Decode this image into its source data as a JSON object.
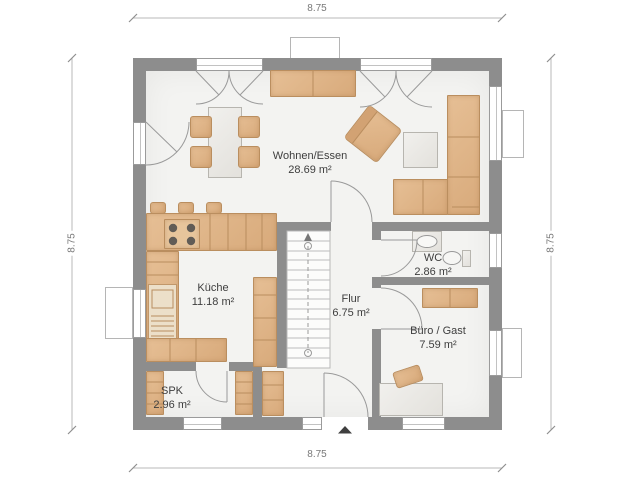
{
  "dimensions": {
    "top": "8.75",
    "right": "8.75",
    "bottom": "8.75",
    "left": "8.75"
  },
  "rooms": {
    "wohnen": {
      "name": "Wohnen/Essen",
      "area": "28.69 m²"
    },
    "kueche": {
      "name": "Küche",
      "area": "11.18 m²"
    },
    "wc": {
      "name": "WC",
      "area": "2.86 m²"
    },
    "flur": {
      "name": "Flur",
      "area": "6.75 m²"
    },
    "buero": {
      "name": "Büro / Gast",
      "area": "7.59 m²"
    },
    "spk": {
      "name": "SPK",
      "area": "2.96 m²"
    }
  },
  "colors": {
    "wall": "#8d8d8d",
    "furniture": "#ddb189",
    "furniture_outline": "#ba8e5f",
    "floor": "#f3f3f1",
    "plan_lines": "#9a9a9a",
    "label_text": "#3e3e3e",
    "dimension_text": "#787878"
  }
}
